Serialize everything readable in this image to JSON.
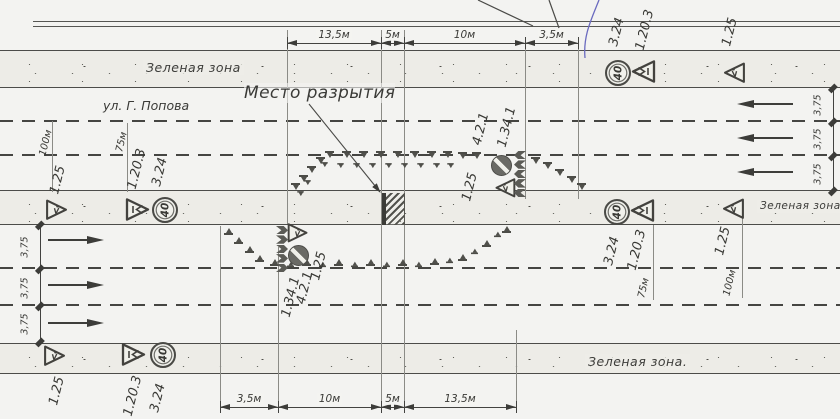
{
  "labels": {
    "green_zone_top": "Зеленая зона",
    "green_zone_median": "Зеленая зона",
    "green_zone_bottom": "Зеленая зона.",
    "street": "ул. Г. Попова",
    "excavation": "Место разрытия",
    "lane_width": "3,75",
    "speed_limit": "40"
  },
  "dimensions": {
    "top": [
      {
        "label": "13,5м",
        "x1": 287,
        "x2": 381
      },
      {
        "label": "5м",
        "x1": 381,
        "x2": 404
      },
      {
        "label": "10м",
        "x1": 404,
        "x2": 525
      },
      {
        "label": "3,5м",
        "x1": 525,
        "x2": 578
      }
    ],
    "bottom": [
      {
        "label": "3,5м",
        "x1": 220,
        "x2": 278
      },
      {
        "label": "10м",
        "x1": 278,
        "x2": 381
      },
      {
        "label": "5м",
        "x1": 381,
        "x2": 404
      },
      {
        "label": "13,5м",
        "x1": 404,
        "x2": 516
      }
    ]
  },
  "sign_labels": [
    {
      "text": "3.24",
      "cx": 617,
      "cy": 32
    },
    {
      "text": "1.20.3",
      "cx": 645,
      "cy": 30
    },
    {
      "text": "1.25",
      "cx": 730,
      "cy": 32
    },
    {
      "text": "3.24",
      "cx": 612,
      "cy": 251
    },
    {
      "text": "1.20.3",
      "cx": 637,
      "cy": 250
    },
    {
      "text": "75м",
      "cx": 644,
      "cy": 288,
      "small": true
    },
    {
      "text": "1.25",
      "cx": 723,
      "cy": 241
    },
    {
      "text": "100м",
      "cx": 730,
      "cy": 283,
      "small": true
    },
    {
      "text": "100м",
      "cx": 46,
      "cy": 143,
      "small": true
    },
    {
      "text": "75м",
      "cx": 122,
      "cy": 142,
      "small": true
    },
    {
      "text": "1.25",
      "cx": 58,
      "cy": 180
    },
    {
      "text": "1.20.3",
      "cx": 137,
      "cy": 169
    },
    {
      "text": "3.24",
      "cx": 160,
      "cy": 172
    },
    {
      "text": "1.25",
      "cx": 57,
      "cy": 391
    },
    {
      "text": "1.20.3",
      "cx": 133,
      "cy": 396
    },
    {
      "text": "3.24",
      "cx": 158,
      "cy": 398
    },
    {
      "text": "4.2.1",
      "cx": 481,
      "cy": 129
    },
    {
      "text": "1.34.1",
      "cx": 507,
      "cy": 127
    },
    {
      "text": "1.25",
      "cx": 470,
      "cy": 187
    },
    {
      "text": "1.25",
      "cx": 319,
      "cy": 266
    },
    {
      "text": "4.2.1",
      "cx": 305,
      "cy": 288
    },
    {
      "text": "1.34.1",
      "cx": 291,
      "cy": 297
    }
  ],
  "signs": [
    {
      "kind": "speed",
      "name": "sign-3.24-speed-limit-40",
      "x": 605,
      "y": 60
    },
    {
      "kind": "warning",
      "name": "sign-1.20.3-road-narrows",
      "x": 630,
      "y": 59,
      "dir": "left",
      "glyph": "narrowing"
    },
    {
      "kind": "warning",
      "name": "sign-1.25-roadworks",
      "x": 721,
      "y": 60,
      "dir": "left",
      "glyph": "roadworks",
      "s": 0.9
    },
    {
      "kind": "speed",
      "name": "sign-3.24-speed-limit-40",
      "x": 604,
      "y": 199
    },
    {
      "kind": "warning",
      "name": "sign-1.20.3-road-narrows",
      "x": 629,
      "y": 198,
      "dir": "left",
      "glyph": "narrowing"
    },
    {
      "kind": "warning",
      "name": "sign-1.25-roadworks",
      "x": 720,
      "y": 196,
      "dir": "left",
      "glyph": "roadworks",
      "s": 0.9
    },
    {
      "kind": "speed",
      "name": "sign-3.24-speed-limit-40",
      "x": 152,
      "y": 197
    },
    {
      "kind": "warning",
      "name": "sign-1.20.3-road-narrows",
      "x": 125,
      "y": 197,
      "dir": "right",
      "glyph": "narrowing"
    },
    {
      "kind": "warning",
      "name": "sign-1.25-roadworks",
      "x": 44,
      "y": 197,
      "dir": "right",
      "glyph": "roadworks",
      "s": 0.9
    },
    {
      "kind": "speed",
      "name": "sign-3.24-speed-limit-40",
      "x": 150,
      "y": 342
    },
    {
      "kind": "warning",
      "name": "sign-1.20.3-road-narrows",
      "x": 121,
      "y": 342,
      "dir": "right",
      "glyph": "narrowing"
    },
    {
      "kind": "warning",
      "name": "sign-1.25-roadworks",
      "x": 42,
      "y": 343,
      "dir": "right",
      "glyph": "roadworks",
      "s": 0.9
    },
    {
      "kind": "keep",
      "name": "sign-4.2.1-pass-this-side",
      "x": 491,
      "y": 155
    },
    {
      "kind": "warning",
      "name": "sign-1.25-roadworks",
      "x": 492,
      "y": 175,
      "dir": "left",
      "glyph": "roadworks",
      "s": 0.85
    },
    {
      "kind": "chevrons",
      "name": "sign-1.34.1-chevrons",
      "x": 514,
      "y": 151,
      "dir": "left"
    },
    {
      "kind": "keep",
      "name": "sign-4.2.1-pass-this-side",
      "x": 288,
      "y": 245
    },
    {
      "kind": "warning",
      "name": "sign-1.25-roadworks",
      "x": 285,
      "y": 220,
      "dir": "right",
      "glyph": "roadworks",
      "s": 0.85
    },
    {
      "kind": "chevrons",
      "name": "sign-1.34.1-chevrons",
      "x": 276,
      "y": 226,
      "dir": "right"
    }
  ],
  "cones": [
    {
      "style": "down",
      "scale": 1,
      "pts": [
        [
          291,
          183
        ],
        [
          299,
          175
        ],
        [
          307,
          166
        ],
        [
          316,
          157
        ],
        [
          325,
          151
        ],
        [
          342,
          151
        ],
        [
          359,
          151
        ],
        [
          376,
          151
        ],
        [
          393,
          151
        ],
        [
          410,
          151
        ],
        [
          427,
          151
        ],
        [
          443,
          151
        ],
        [
          458,
          152
        ],
        [
          472,
          152
        ],
        [
          531,
          157
        ],
        [
          543,
          162
        ],
        [
          555,
          169
        ],
        [
          567,
          176
        ],
        [
          577,
          183
        ]
      ]
    },
    {
      "style": "down",
      "scale": 0.72,
      "pts": [
        [
          320,
          161
        ],
        [
          336,
          162
        ],
        [
          352,
          162
        ],
        [
          368,
          162
        ],
        [
          384,
          162
        ],
        [
          400,
          162
        ],
        [
          416,
          162
        ],
        [
          432,
          162
        ],
        [
          446,
          162
        ],
        [
          296,
          190
        ],
        [
          303,
          179
        ]
      ]
    },
    {
      "style": "up",
      "scale": 1,
      "pts": [
        [
          224,
          227
        ],
        [
          234,
          236
        ],
        [
          245,
          245
        ],
        [
          255,
          254
        ],
        [
          270,
          258
        ],
        [
          302,
          258
        ],
        [
          334,
          258
        ],
        [
          366,
          258
        ],
        [
          398,
          258
        ],
        [
          430,
          257
        ],
        [
          458,
          253
        ],
        [
          482,
          239
        ],
        [
          502,
          225
        ]
      ]
    },
    {
      "style": "up",
      "scale": 0.78,
      "pts": [
        [
          286,
          260
        ],
        [
          318,
          260
        ],
        [
          350,
          260
        ],
        [
          382,
          260
        ],
        [
          414,
          260
        ],
        [
          445,
          256
        ],
        [
          470,
          247
        ],
        [
          493,
          230
        ]
      ]
    }
  ],
  "traffic_arrows": [
    {
      "x": 737,
      "y": 100,
      "dir": "left"
    },
    {
      "x": 737,
      "y": 134,
      "dir": "left"
    },
    {
      "x": 737,
      "y": 168,
      "dir": "left"
    },
    {
      "x": 48,
      "y": 236,
      "dir": "right"
    },
    {
      "x": 48,
      "y": 281,
      "dir": "right"
    },
    {
      "x": 48,
      "y": 319,
      "dir": "right"
    }
  ],
  "lane_width_dims": [
    {
      "line_x": 833,
      "bounds": [
        88,
        122,
        156,
        191
      ],
      "label_x": 818
    },
    {
      "line_x": 40,
      "bounds": [
        225,
        269,
        306,
        342
      ],
      "label_x": 25
    }
  ],
  "extension_lines": [
    [
      52,
      121,
      192
    ],
    [
      127,
      123,
      192
    ],
    [
      287,
      30,
      224
    ],
    [
      381,
      30,
      407
    ],
    [
      404,
      30,
      407
    ],
    [
      525,
      46,
      199
    ],
    [
      578,
      46,
      199
    ],
    [
      220,
      226,
      407
    ],
    [
      278,
      247,
      407
    ],
    [
      516,
      330,
      407
    ],
    [
      653,
      225,
      300
    ],
    [
      742,
      217,
      298
    ]
  ]
}
